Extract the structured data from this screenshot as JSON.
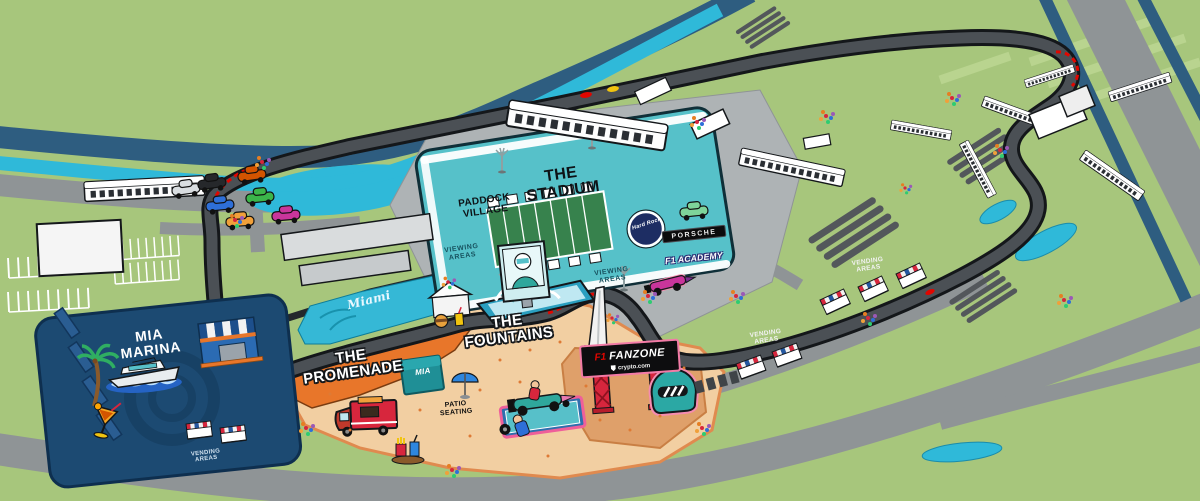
{
  "map_title": "Miami International Autodrome campus illustration",
  "stadium": {
    "title": "THE STADIUM",
    "paddock_village": "PADDOCK VILLAGE",
    "hard_rock_logo": "Hard Rock"
  },
  "marina": {
    "title": "MIA MARINA"
  },
  "promenade": {
    "title": "THE PROMENADE",
    "mia_store": "MIA",
    "water_script": "Miami"
  },
  "fountains": {
    "title": "THE FOUNTAINS",
    "patio_seating": "PATIO SEATING"
  },
  "fanzone": {
    "f1_logo": "F1",
    "name": "FANZONE",
    "sponsor": "crypto.com"
  },
  "signs": {
    "porsche": "PORSCHE",
    "f1_academy": "F1 ACADEMY"
  },
  "labels": {
    "viewing_areas": [
      "VIEWING AREAS",
      "VIEWING AREAS"
    ],
    "vending_areas": [
      "VENDING AREAS",
      "VENDING AREAS",
      "VENDING AREAS"
    ]
  },
  "colors": {
    "field_green": "#a7c67c",
    "road_gray": "#8f9496",
    "track_gray": "#4b5055",
    "canal_teal": "#2fb9d9",
    "highway_blue": "#2e5d80",
    "stadium_teal": "#56c1c9",
    "marina_navy": "#1c4a72",
    "promenade_orange": "#e8762a",
    "fountains_tan": "#f2cfa2",
    "fanzone_tan": "#dfa06a",
    "accent_pink": "#f27ba6",
    "f1_red": "#e10600"
  }
}
